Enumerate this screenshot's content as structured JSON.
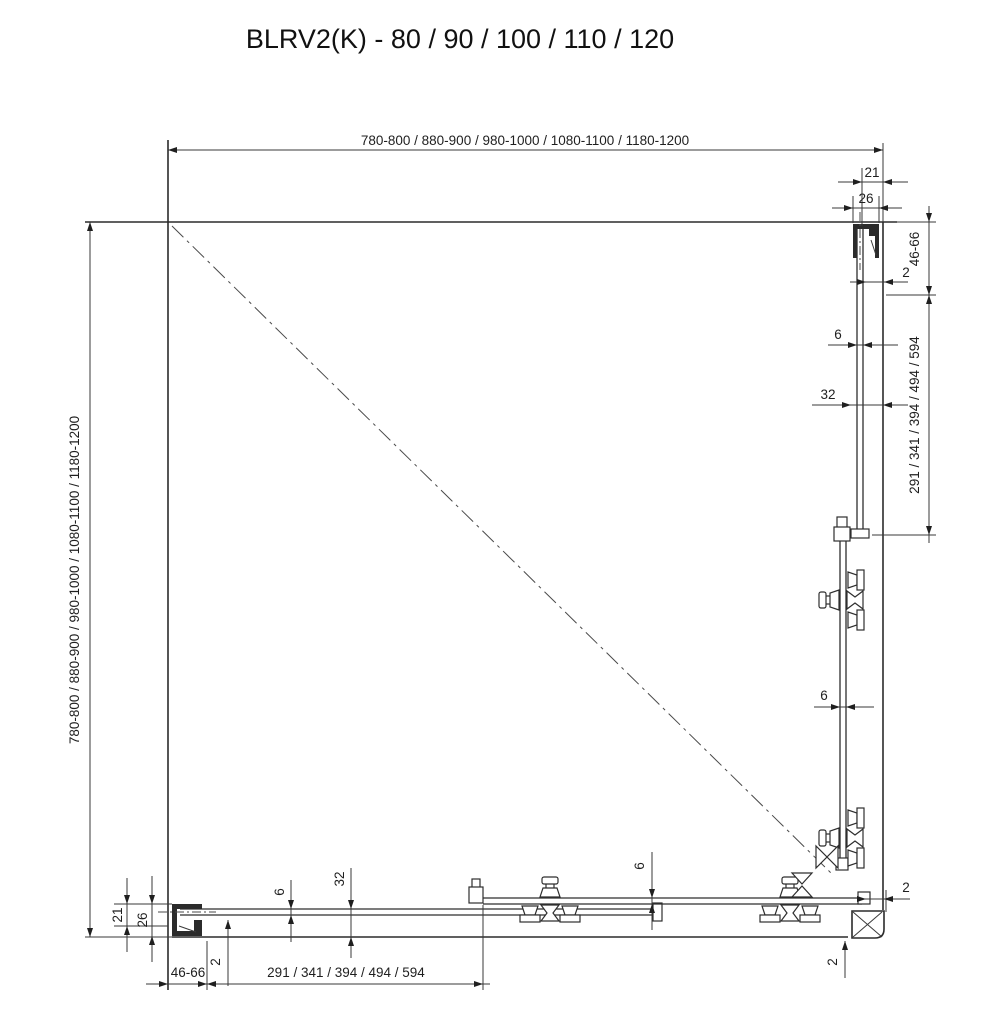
{
  "title": "BLRV2(K) - 80 / 90 / 100 / 110 / 120",
  "dimensions": {
    "width_range": "780-800 / 880-900 / 980-1000 / 1080-1100 / 1180-1200",
    "depth_range": "780-800 / 880-900 / 980-1000 / 1080-1100 / 1180-1200",
    "fixed_panel_lengths": "291 / 341 / 394 / 494 / 594",
    "wall_profile_depth": "21",
    "wall_profile_width": "26",
    "adjustment_range": "46-66",
    "glass_thickness": "6",
    "track_offset": "32",
    "clearance": "2"
  }
}
